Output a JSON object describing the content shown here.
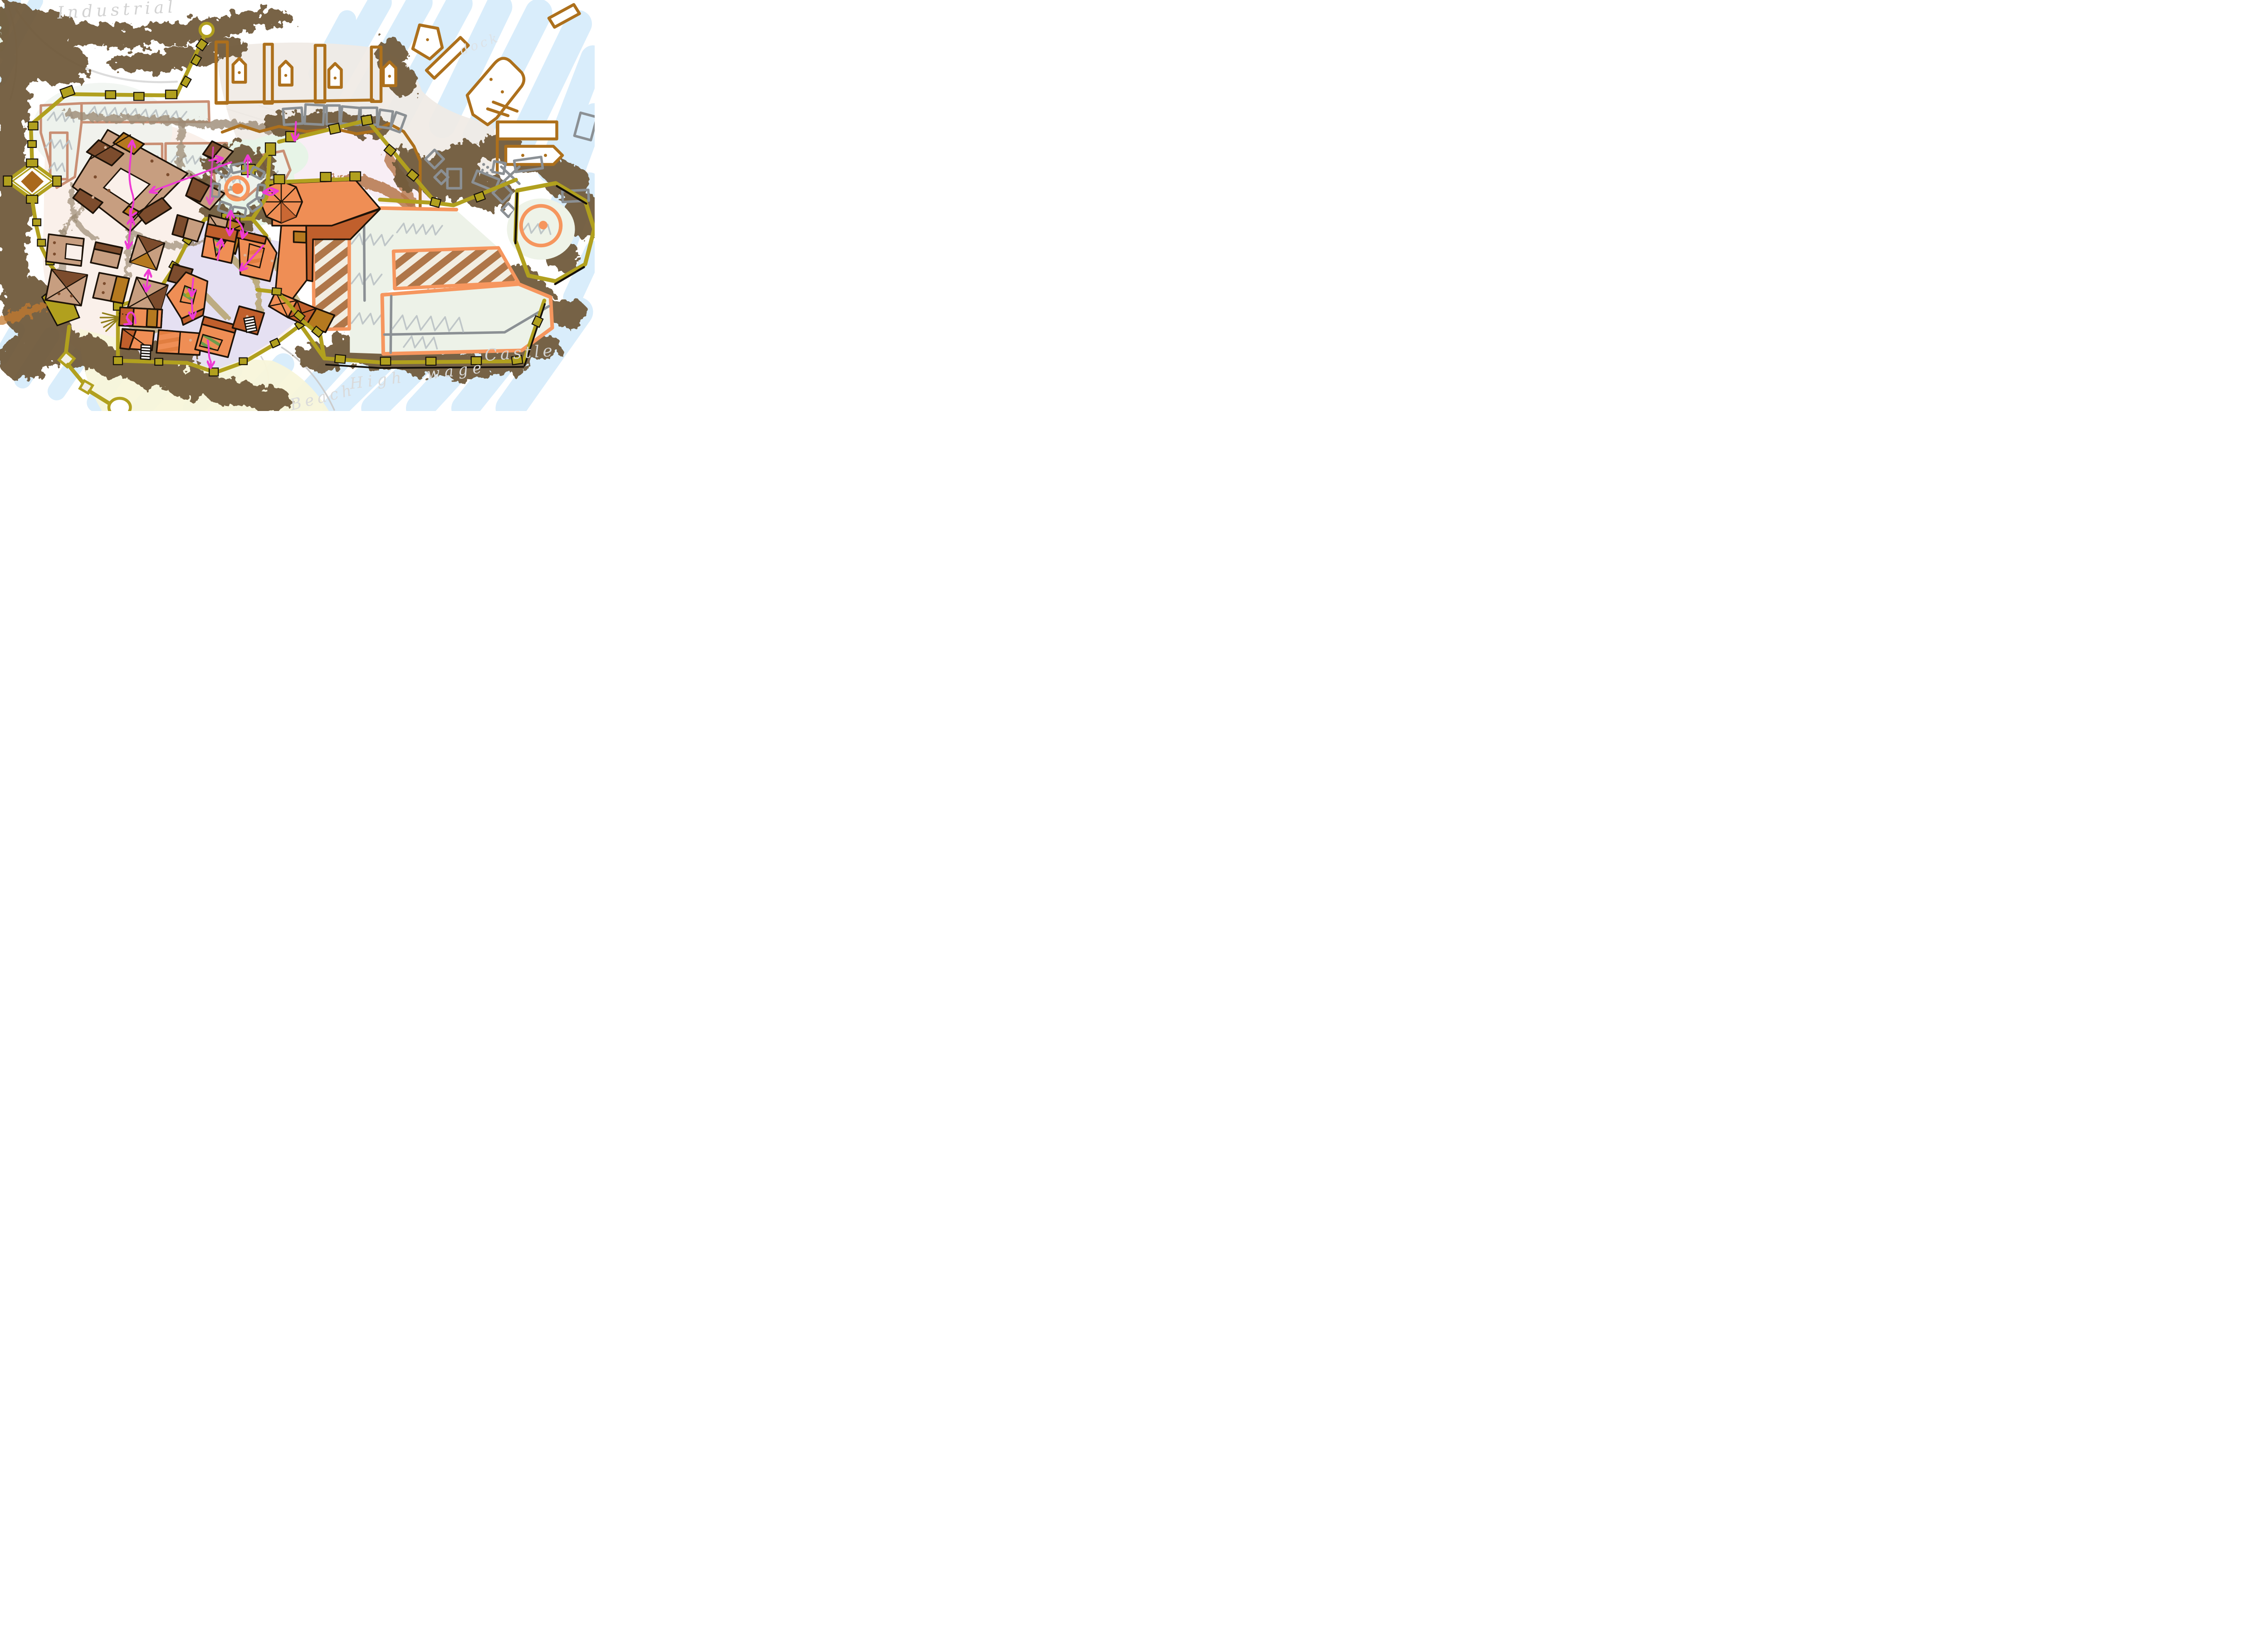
{
  "page": {
    "title": "Hand-drawn city districts concept map"
  },
  "labels": {
    "industrial": "Industrial",
    "dock": "dock",
    "castle": "Castle",
    "high_wage": "High wage",
    "beach": "Beach"
  },
  "districts": [
    {
      "id": "industrial-fields",
      "label_ref": "industrial"
    },
    {
      "id": "dock-piers",
      "label_ref": "dock"
    },
    {
      "id": "old-town",
      "label_ref": null
    },
    {
      "id": "orange-lower-town",
      "label_ref": null
    },
    {
      "id": "castle-complex",
      "label_ref": "castle"
    },
    {
      "id": "market-amphitheatre",
      "label_ref": null
    },
    {
      "id": "beach-shore",
      "label_ref": "beach"
    },
    {
      "id": "harbour-water",
      "label_ref": "high_wage"
    }
  ],
  "colors": {
    "paper": "#ffffff",
    "water": "#d9edfb",
    "forest": "#6e5939",
    "dirt": "#9b8a74",
    "wall": "#b1a01e",
    "dock_line": "#ad701c",
    "plot_outline": "#c98f74",
    "old_town_wall_fill": "#c79e80",
    "old_town_roof_dark": "#7c4c2d",
    "ochre": "#b5791f",
    "district_orange": "#ef8e55",
    "district_orange_dark": "#c05f2c",
    "castle_orange": "#f6965e",
    "mint": "#e7f4e7",
    "courtyard_green": "#edf2e8",
    "grass_green": "#6fae57",
    "lavender": "#e3def2",
    "market_pink": "#f8eef5",
    "beach_sand": "#f8f6da",
    "field_brown": "#a3622e",
    "sketch_gray": "#8b9094",
    "scribble_gray": "#b6bec2",
    "label_gray": "#d2d2d2",
    "arrow_magenta": "#ee3bd4",
    "ground_tan": "#efeae4",
    "old_town_ground": "#faf0ea"
  }
}
